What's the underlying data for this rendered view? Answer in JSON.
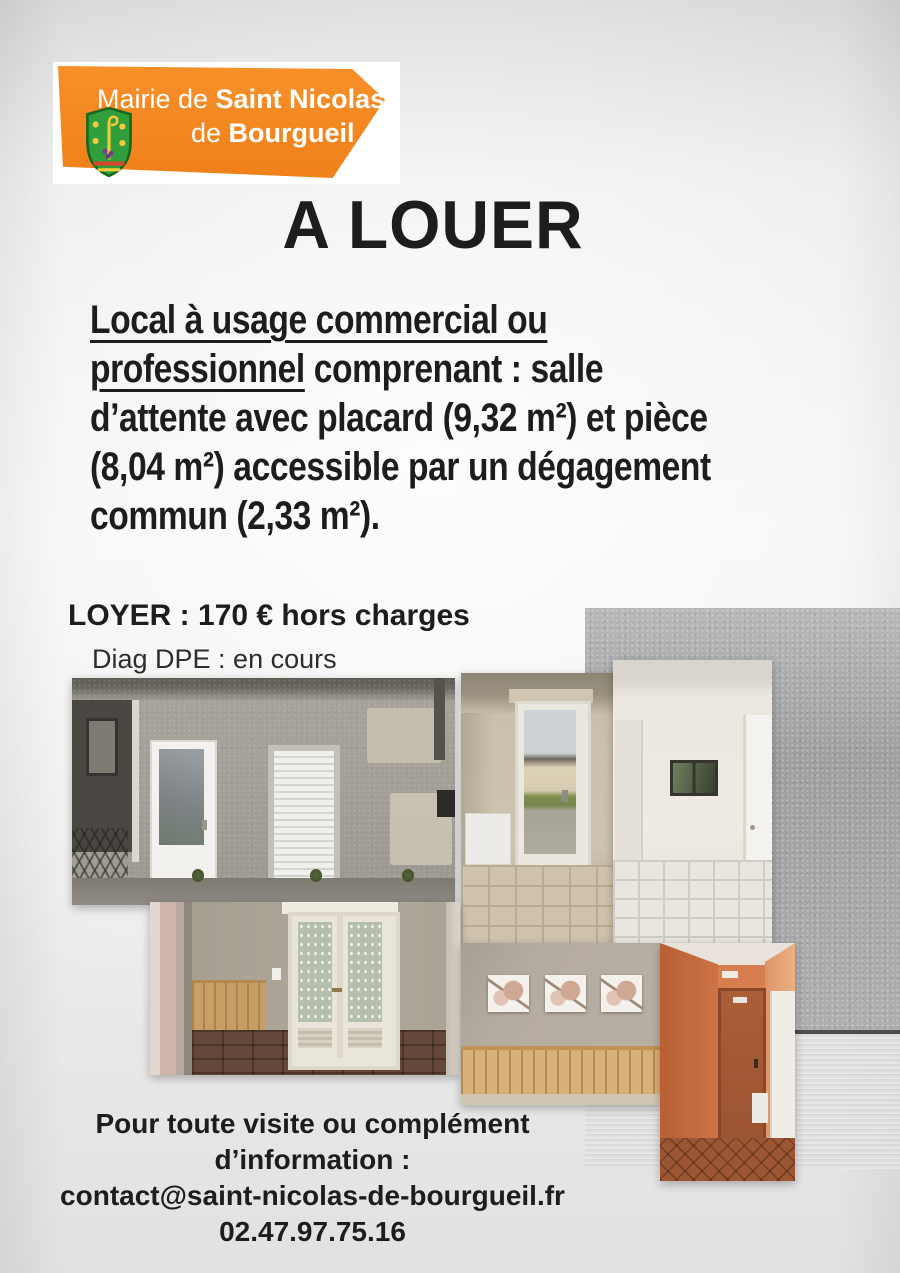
{
  "colors": {
    "accent_orange": "#f0801a",
    "shield_green": "#2f9e3b",
    "text": "#1d1d1b",
    "background_gray": "#ececec"
  },
  "logo": {
    "line1_light": "Mairie de ",
    "line1_bold": "Saint Nicolas",
    "line2_light": "de ",
    "line2_bold": "Bourgueil"
  },
  "title": "A LOUER",
  "description": {
    "lines": [
      {
        "underlined": "Local à usage commercial ou",
        "rest": ""
      },
      {
        "underlined": "professionnel",
        "rest": " comprenant : salle"
      },
      {
        "underlined": "",
        "rest": "d’attente avec placard (9,32 m²) et pièce"
      },
      {
        "underlined": "",
        "rest": "(8,04 m²) accessible par un dégagement"
      },
      {
        "underlined": "",
        "rest": "commun (2,33 m²)."
      }
    ]
  },
  "pricing": {
    "rent_line": "LOYER : 170 € hors charges",
    "dpe_line": "Diag DPE : en cours"
  },
  "contact": {
    "lines": [
      "Pour toute visite ou complément",
      "d’information :",
      "contact@saint-nicolas-de-bourgueil.fr",
      "02.47.97.75.16"
    ]
  }
}
